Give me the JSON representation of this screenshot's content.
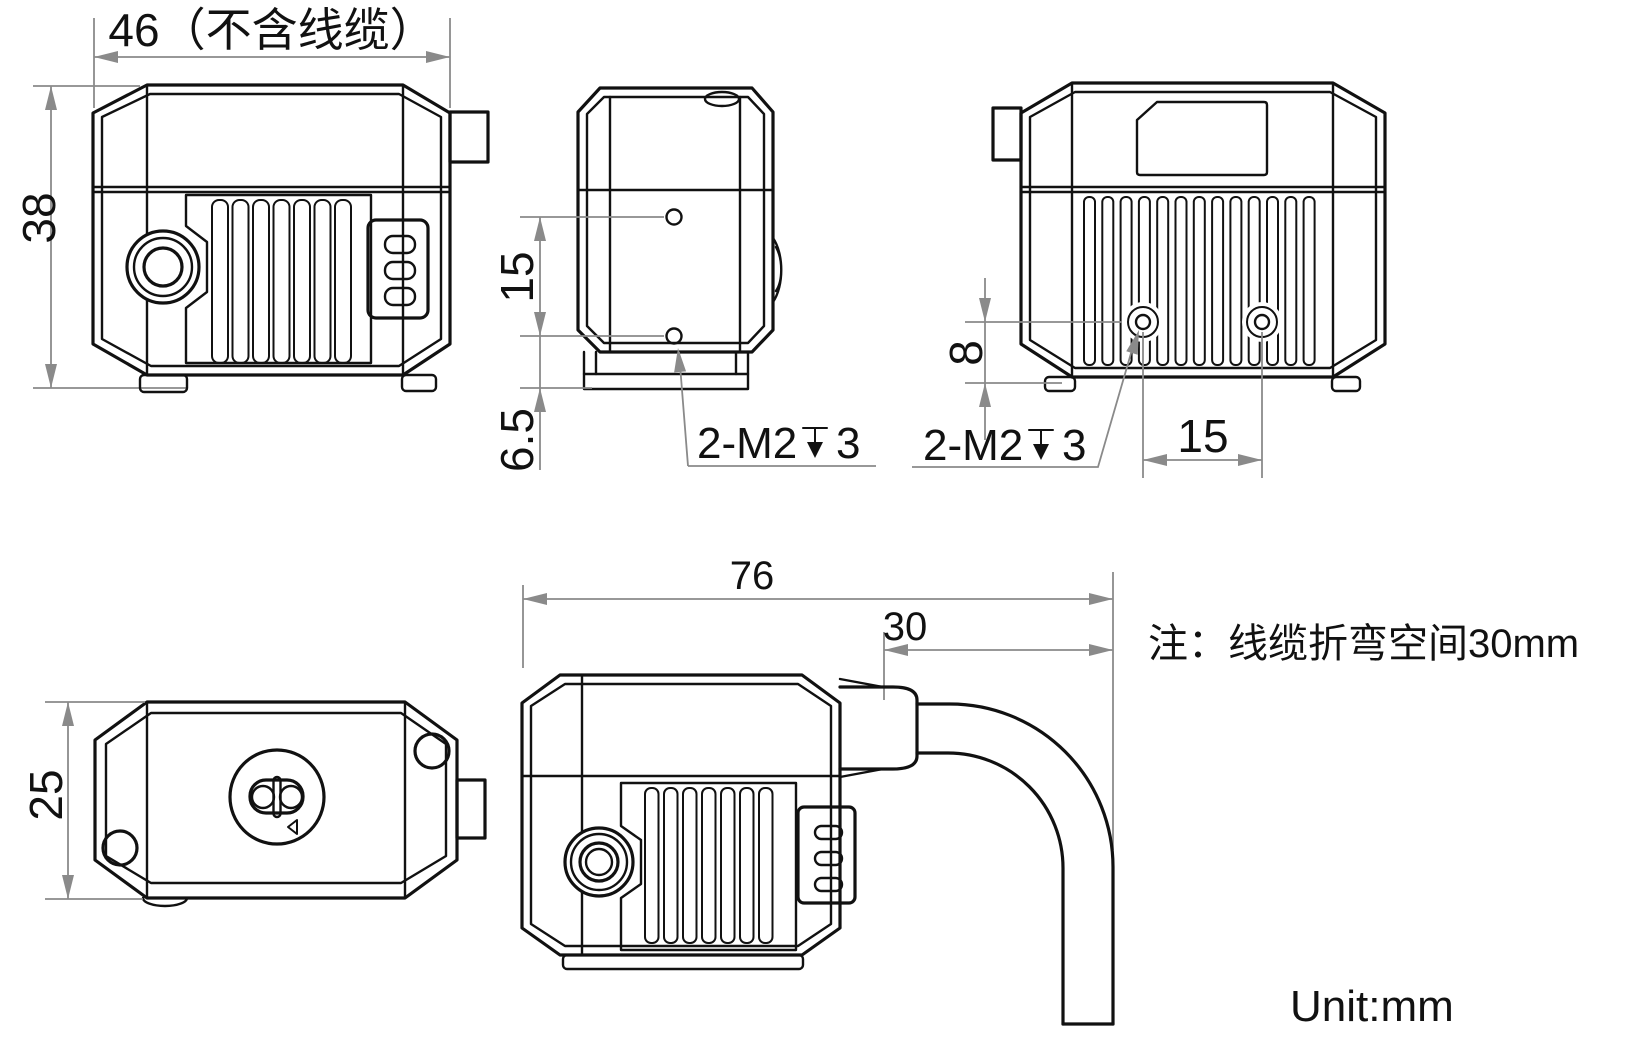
{
  "drawing": {
    "colors": {
      "line": "#111111",
      "dimension": "#8a8a8a",
      "background": "#ffffff"
    },
    "note": "注：线缆折弯空间30mm",
    "unit": "Unit:mm",
    "views": {
      "front": {
        "width_label": "46（不含线缆）",
        "height_label": "38"
      },
      "side": {
        "hole_spacing_label": "15",
        "hole_to_edge_label": "6.5",
        "thread": {
          "prefix": "2-M2",
          "depth": "3"
        }
      },
      "rear": {
        "hole_height_label": "8",
        "hole_spacing_label": "15",
        "thread": {
          "prefix": "2-M2",
          "depth": "3"
        }
      },
      "top": {
        "depth_label": "25"
      },
      "cable": {
        "total_width_label": "76",
        "bend_space_label": "30"
      }
    }
  }
}
